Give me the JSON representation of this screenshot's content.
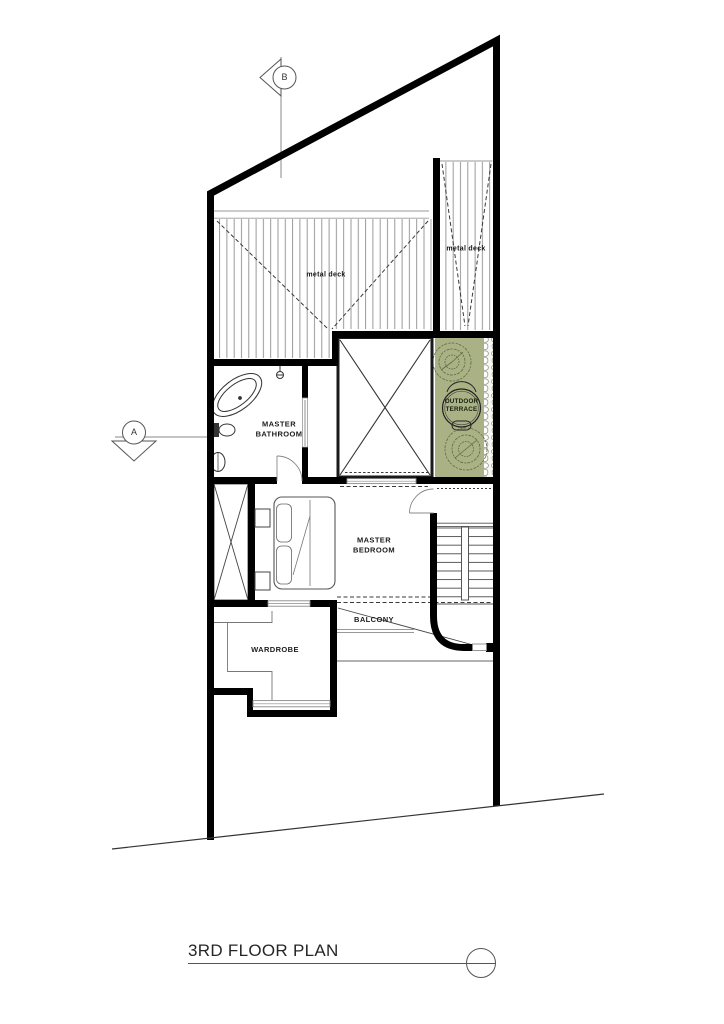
{
  "title": {
    "text": "3RD FLOOR PLAN"
  },
  "markers": {
    "a": "A",
    "b": "B"
  },
  "rooms": {
    "master_bathroom": "MASTER BATHROOM",
    "master_bedroom": "MASTER BEDROOM",
    "wardrobe": "WARDROBE",
    "balcony": "BALCONY",
    "outdoor_terrace": "OUTDOOR TERRACE"
  },
  "annotations": {
    "metal_deck_main": "metal deck",
    "metal_deck_right": "metal deck"
  },
  "colors": {
    "terrace_green": "#a9b185",
    "tree_green": "#5c6b45",
    "wall_black": "#000000",
    "line_gray": "#666666",
    "pebble_gray": "#9a9a92"
  }
}
